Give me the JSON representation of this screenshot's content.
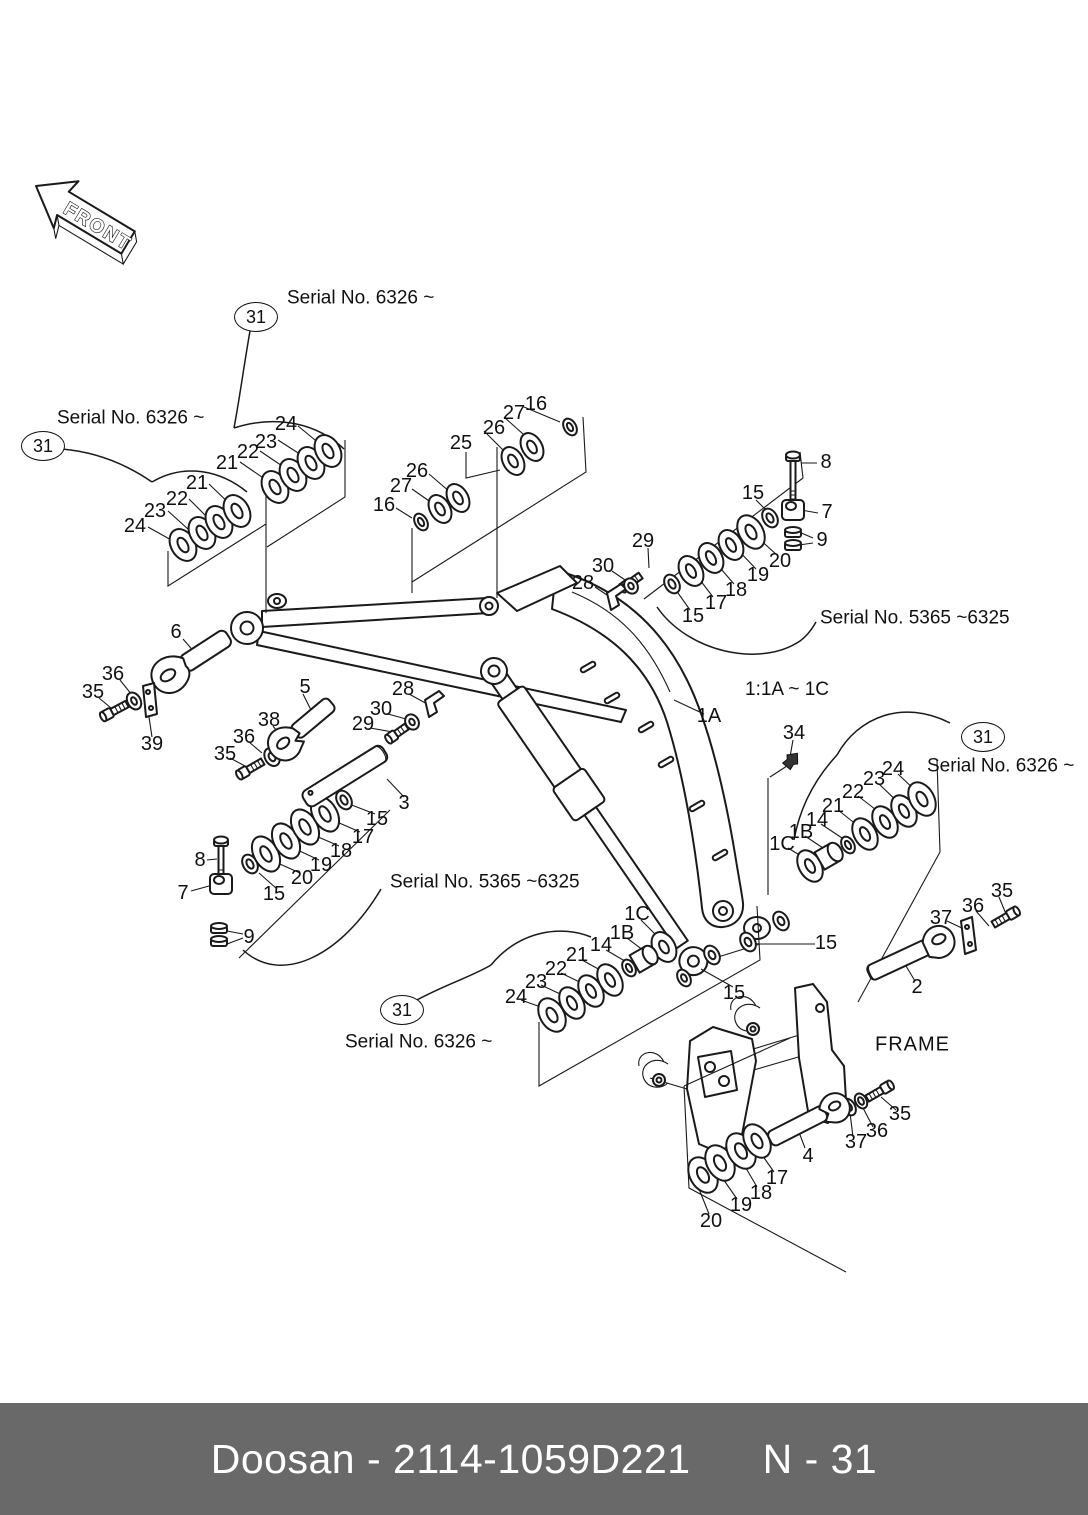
{
  "page": {
    "background": "#ffffff",
    "line_color": "#1a1a1a"
  },
  "front_arrow": {
    "label": "FRONT"
  },
  "notes": {
    "scale_note": {
      "text": "1:1A ~ 1C",
      "x": 745,
      "y": 690
    },
    "frame_label": {
      "text": "FRAME",
      "x": 875,
      "y": 1045
    }
  },
  "serial_notes": [
    {
      "text": "Serial No. 6326 ~",
      "x": 287,
      "y": 298
    },
    {
      "text": "Serial No. 6326 ~",
      "x": 57,
      "y": 418
    },
    {
      "text": "Serial No. 5365 ~6325",
      "x": 820,
      "y": 618
    },
    {
      "text": "Serial No. 5365 ~6325",
      "x": 390,
      "y": 882
    },
    {
      "text": "Serial No. 6326 ~",
      "x": 927,
      "y": 766
    },
    {
      "text": "Serial No. 6326 ~",
      "x": 345,
      "y": 1042
    }
  ],
  "balloons": [
    {
      "label": "31",
      "x": 256,
      "y": 317
    },
    {
      "label": "31",
      "x": 43,
      "y": 446
    },
    {
      "label": "31",
      "x": 983,
      "y": 737
    },
    {
      "label": "31",
      "x": 402,
      "y": 1010
    }
  ],
  "callouts": [
    {
      "label": "21",
      "x": 227,
      "y": 463
    },
    {
      "label": "22",
      "x": 248,
      "y": 452
    },
    {
      "label": "23",
      "x": 266,
      "y": 442
    },
    {
      "label": "24",
      "x": 286,
      "y": 424
    },
    {
      "label": "21",
      "x": 197,
      "y": 483
    },
    {
      "label": "22",
      "x": 177,
      "y": 499
    },
    {
      "label": "23",
      "x": 155,
      "y": 511
    },
    {
      "label": "24",
      "x": 135,
      "y": 526
    },
    {
      "label": "16",
      "x": 536,
      "y": 404
    },
    {
      "label": "27",
      "x": 514,
      "y": 413
    },
    {
      "label": "26",
      "x": 494,
      "y": 428
    },
    {
      "label": "25",
      "x": 461,
      "y": 443
    },
    {
      "label": "26",
      "x": 417,
      "y": 471
    },
    {
      "label": "27",
      "x": 401,
      "y": 486
    },
    {
      "label": "16",
      "x": 384,
      "y": 505
    },
    {
      "label": "8",
      "x": 826,
      "y": 462
    },
    {
      "label": "7",
      "x": 827,
      "y": 512
    },
    {
      "label": "9",
      "x": 822,
      "y": 540
    },
    {
      "label": "15",
      "x": 753,
      "y": 493
    },
    {
      "label": "20",
      "x": 780,
      "y": 561
    },
    {
      "label": "19",
      "x": 758,
      "y": 575
    },
    {
      "label": "18",
      "x": 736,
      "y": 590
    },
    {
      "label": "17",
      "x": 716,
      "y": 603
    },
    {
      "label": "15",
      "x": 693,
      "y": 616
    },
    {
      "label": "29",
      "x": 643,
      "y": 541
    },
    {
      "label": "30",
      "x": 603,
      "y": 566
    },
    {
      "label": "28",
      "x": 583,
      "y": 583
    },
    {
      "label": "6",
      "x": 176,
      "y": 632
    },
    {
      "label": "36",
      "x": 113,
      "y": 674
    },
    {
      "label": "35",
      "x": 93,
      "y": 692
    },
    {
      "label": "39",
      "x": 152,
      "y": 744
    },
    {
      "label": "5",
      "x": 305,
      "y": 687
    },
    {
      "label": "38",
      "x": 269,
      "y": 720
    },
    {
      "label": "36",
      "x": 244,
      "y": 737
    },
    {
      "label": "35",
      "x": 225,
      "y": 754
    },
    {
      "label": "28",
      "x": 403,
      "y": 689
    },
    {
      "label": "30",
      "x": 381,
      "y": 709
    },
    {
      "label": "29",
      "x": 363,
      "y": 724
    },
    {
      "label": "3",
      "x": 404,
      "y": 803
    },
    {
      "label": "8",
      "x": 200,
      "y": 860
    },
    {
      "label": "7",
      "x": 183,
      "y": 893
    },
    {
      "label": "9",
      "x": 249,
      "y": 937
    },
    {
      "label": "15",
      "x": 274,
      "y": 894
    },
    {
      "label": "20",
      "x": 302,
      "y": 878
    },
    {
      "label": "19",
      "x": 321,
      "y": 865
    },
    {
      "label": "18",
      "x": 341,
      "y": 851
    },
    {
      "label": "17",
      "x": 363,
      "y": 837
    },
    {
      "label": "15",
      "x": 377,
      "y": 819
    },
    {
      "label": "1A",
      "x": 709,
      "y": 716
    },
    {
      "label": "34",
      "x": 794,
      "y": 733
    },
    {
      "label": "24",
      "x": 893,
      "y": 769
    },
    {
      "label": "23",
      "x": 874,
      "y": 779
    },
    {
      "label": "22",
      "x": 853,
      "y": 792
    },
    {
      "label": "21",
      "x": 833,
      "y": 806
    },
    {
      "label": "14",
      "x": 817,
      "y": 820
    },
    {
      "label": "1B",
      "x": 801,
      "y": 832
    },
    {
      "label": "1C",
      "x": 782,
      "y": 844
    },
    {
      "label": "35",
      "x": 1002,
      "y": 891
    },
    {
      "label": "36",
      "x": 973,
      "y": 906
    },
    {
      "label": "37",
      "x": 941,
      "y": 918
    },
    {
      "label": "2",
      "x": 917,
      "y": 987
    },
    {
      "label": "1C",
      "x": 637,
      "y": 914
    },
    {
      "label": "1B",
      "x": 622,
      "y": 933
    },
    {
      "label": "14",
      "x": 601,
      "y": 945
    },
    {
      "label": "21",
      "x": 577,
      "y": 955
    },
    {
      "label": "22",
      "x": 556,
      "y": 969
    },
    {
      "label": "23",
      "x": 536,
      "y": 982
    },
    {
      "label": "24",
      "x": 516,
      "y": 997
    },
    {
      "label": "15",
      "x": 826,
      "y": 943
    },
    {
      "label": "15",
      "x": 734,
      "y": 993
    },
    {
      "label": "35",
      "x": 900,
      "y": 1114
    },
    {
      "label": "36",
      "x": 877,
      "y": 1131
    },
    {
      "label": "37",
      "x": 856,
      "y": 1142
    },
    {
      "label": "4",
      "x": 808,
      "y": 1156
    },
    {
      "label": "17",
      "x": 777,
      "y": 1178
    },
    {
      "label": "18",
      "x": 761,
      "y": 1193
    },
    {
      "label": "19",
      "x": 741,
      "y": 1205
    },
    {
      "label": "20",
      "x": 711,
      "y": 1221
    }
  ],
  "footer": {
    "doc_code": "Doosan - 2114-1059D221",
    "page_ref": "N - 31",
    "background": "#696969",
    "text_color": "#ffffff"
  }
}
